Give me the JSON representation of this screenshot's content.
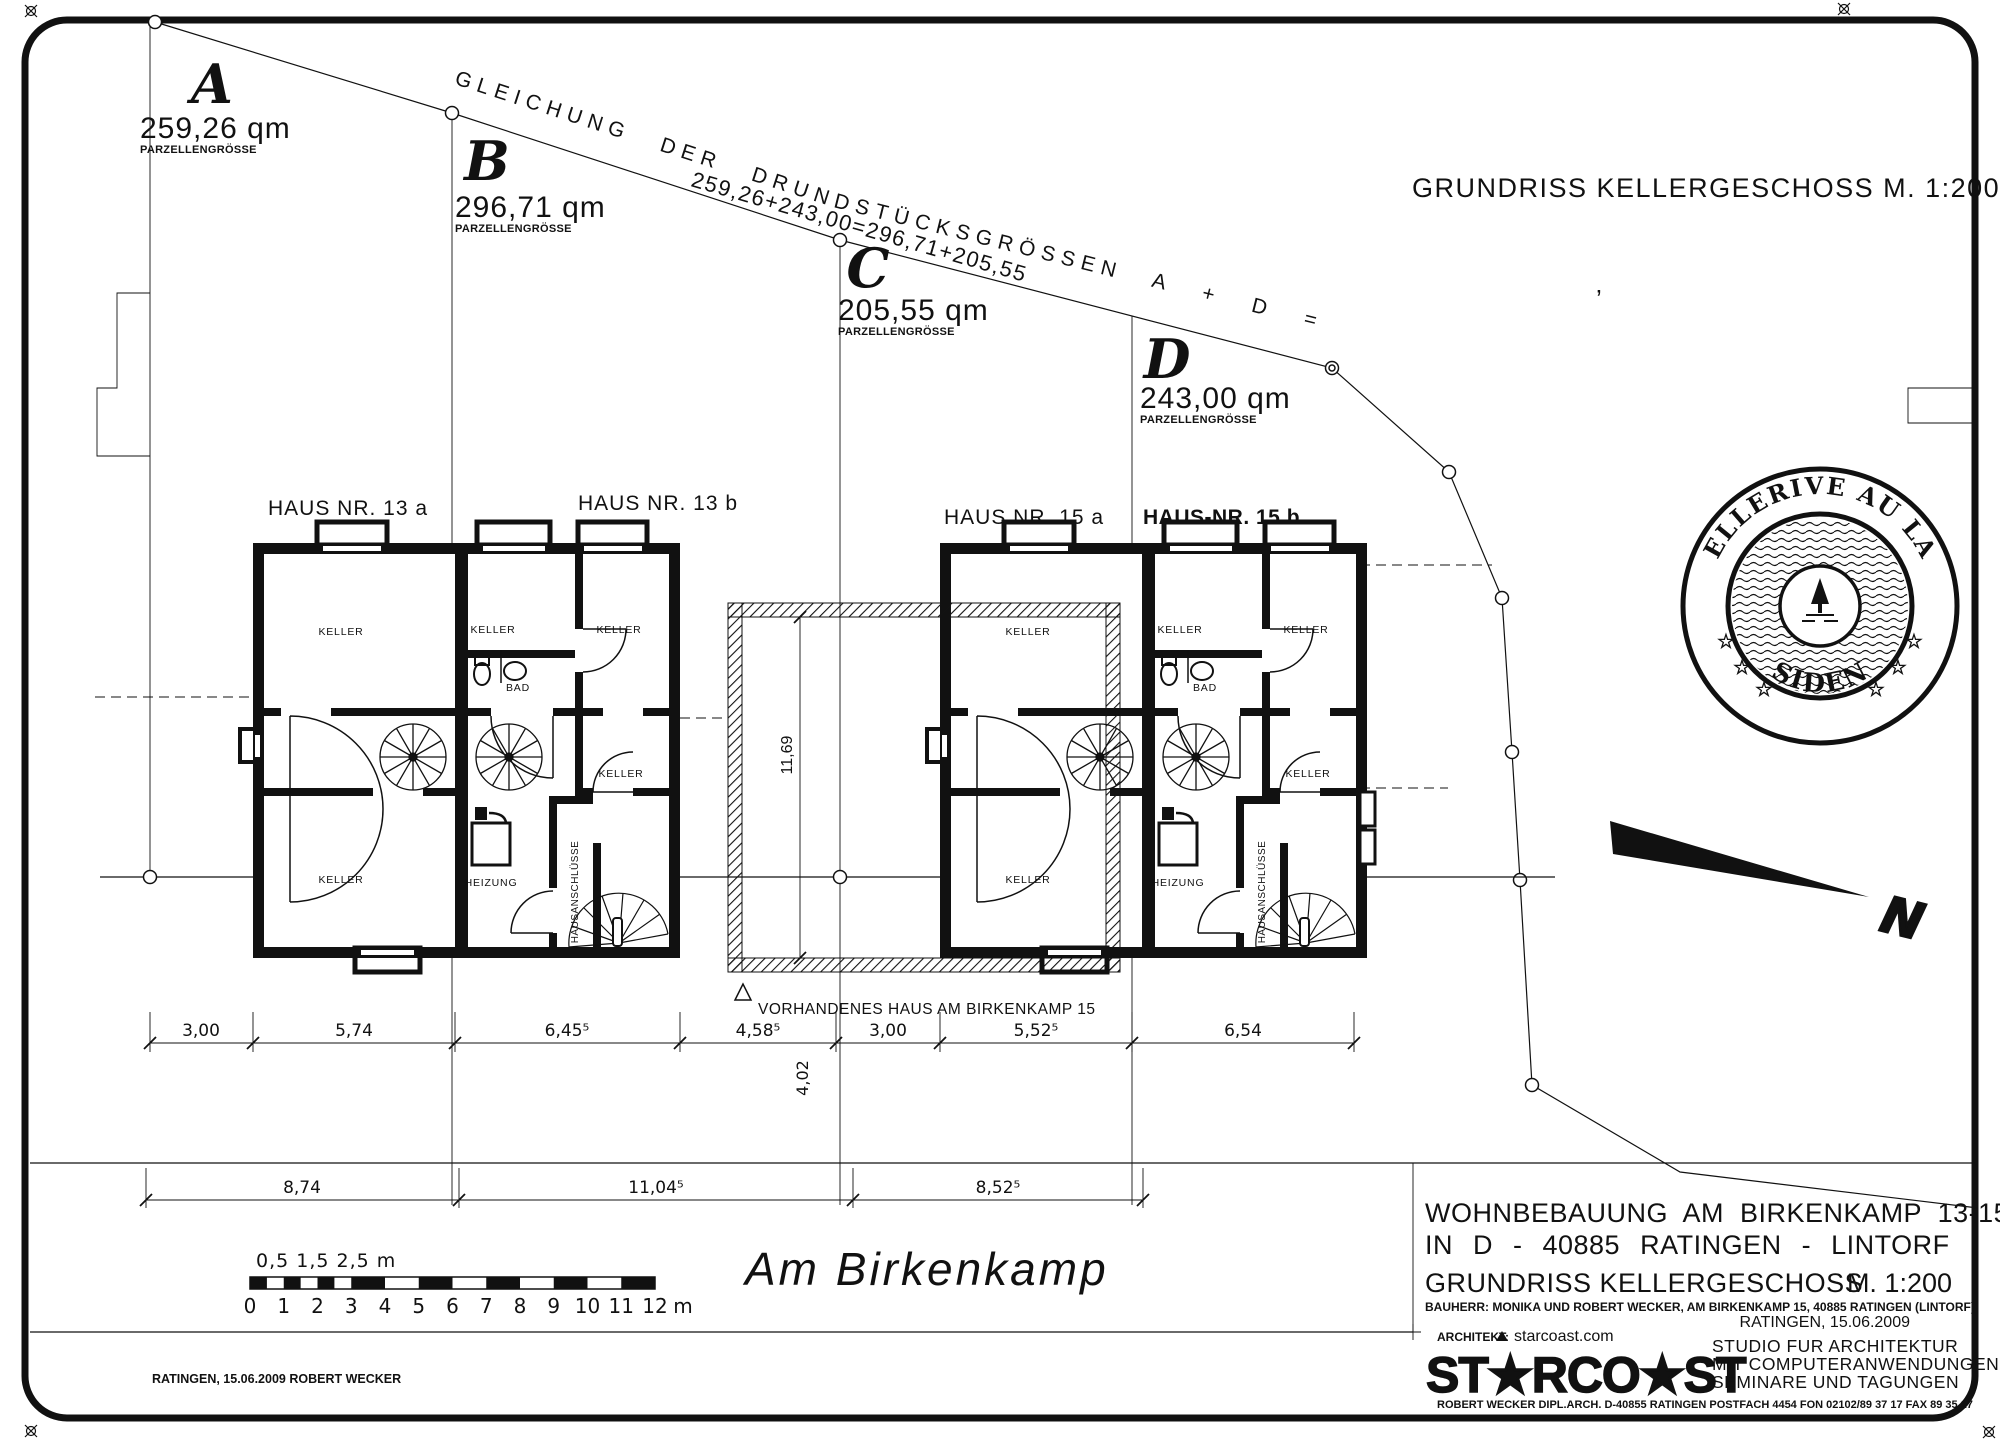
{
  "top_title": "GRUNDRISS KELLERGESCHOSS   M. 1:200",
  "boundary_text": "GLEICHUNG DER DRUNDSTÜCKSGRÖSSEN   A + D = B + C",
  "boundary_equation": "259,26+243,00=296,71+205,55",
  "parcels": {
    "a": {
      "letter": "A",
      "area": "259,26 qm",
      "caption": "PARZELLENGRÖSSE"
    },
    "b": {
      "letter": "B",
      "area": "296,71 qm",
      "caption": "PARZELLENGRÖSSE"
    },
    "c": {
      "letter": "C",
      "area": "205,55 qm",
      "caption": "PARZELLENGRÖSSE"
    },
    "d": {
      "letter": "D",
      "area": "243,00 qm",
      "caption": "PARZELLENGRÖSSE"
    }
  },
  "houses": {
    "h13a": "HAUS NR. 13 a",
    "h13b": "HAUS NR. 13 b",
    "h15a": "HAUS NR. 15 a",
    "h15b": "HAUS-NR. 15 b"
  },
  "rooms": {
    "keller": "KELLER",
    "bad": "BAD",
    "heizung": "HEIZUNG",
    "hausanschluesse": "HAUSANSCHLÜSSE"
  },
  "existing": {
    "label": "VORHANDENES HAUS AM BIRKENKAMP 15",
    "height": "11,69"
  },
  "street": {
    "name": "Am Birkenkamp"
  },
  "dims": {
    "row1": [
      "3,00",
      "5,74",
      "6,45⁵",
      "4,58⁵",
      "3,00",
      "5,52⁵",
      "6,54"
    ],
    "row2": [
      "8,74",
      "11,04⁵",
      "8,52⁵"
    ],
    "vertical": "4,02"
  },
  "scalebar": {
    "sub_label": "0,5 1,5 2,5 m",
    "ticks": [
      "0",
      "1",
      "2",
      "3",
      "4",
      "5",
      "6",
      "7",
      "8",
      "9",
      "10",
      "11",
      "12"
    ],
    "unit": "m"
  },
  "north": {
    "label": "N"
  },
  "stamp": {
    "arc_top": "BELLERIVE AU LAC",
    "arc_bottom": "RESIDENCE",
    "star": "☆"
  },
  "titleblock": {
    "line1": "WOHNBEBAUUNG AM BIRKENKAMP 13-15",
    "line2": "IN D - 40885 RATINGEN - LINTORF",
    "line3": "GRUNDRISS KELLERGESCHOSS",
    "scale": "M. 1:200",
    "bauherr": "BAUHERR:   MONIKA UND ROBERT WECKER, AM BIRKENKAMP 15, 40885 RATINGEN (LINTORF)",
    "date": "RATINGEN, 15.06.2009",
    "architekt": "ARCHITEKT:",
    "web": "starcoast.com",
    "logo": "ST★RCO★ST",
    "studio1": "STUDIO FUR ARCHITEKTUR",
    "studio2": "MIT COMPUTERANWENDUNGEN",
    "studio3": "SEMINARE UND TAGUNGEN",
    "contact": "ROBERT WECKER DIPL.ARCH. D-40855 RATINGEN   POSTFACH 4454 FON 02102/89 37 17 FAX 89 35 17"
  },
  "footer": {
    "left": "RATINGEN, 15.06.2009 ROBERT WECKER"
  }
}
